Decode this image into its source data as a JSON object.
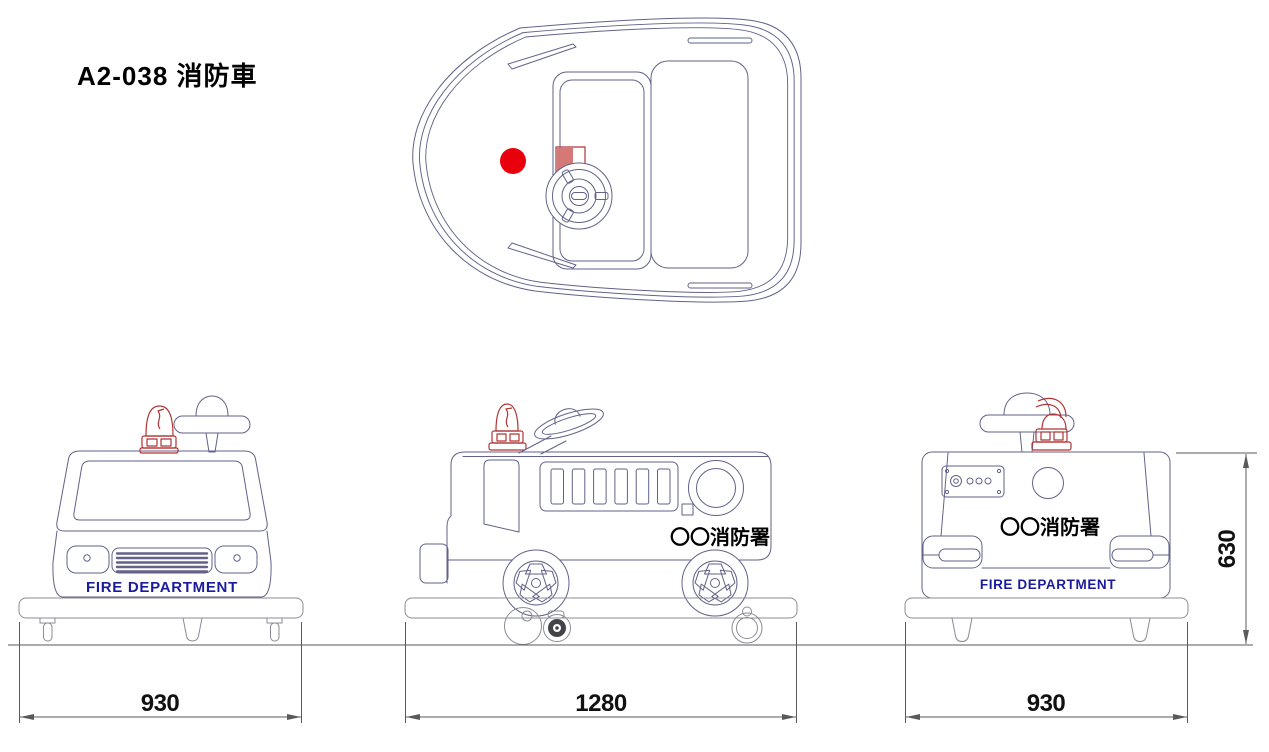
{
  "title": "A2-038 消防車",
  "labels": {
    "front_banner": "FIRE DEPARTMENT",
    "rear_banner": "FIRE DEPARTMENT",
    "side_station": "〇〇消防署",
    "rear_station": "〇〇消防署"
  },
  "dimensions": {
    "front_width_mm": "930",
    "overall_length_mm": "1280",
    "rear_width_mm": "930",
    "overall_height_mm": "630"
  },
  "colors": {
    "background": "#ffffff",
    "outline": "#62628a",
    "platform_outline": "#8b8b96",
    "dimension_line": "#5a5a5a",
    "dimension_text": "#111111",
    "banner_text": "#1b1b9e",
    "station_text": "#000000",
    "beacon_red": "#b13434",
    "dot_red": "#e8000d"
  }
}
